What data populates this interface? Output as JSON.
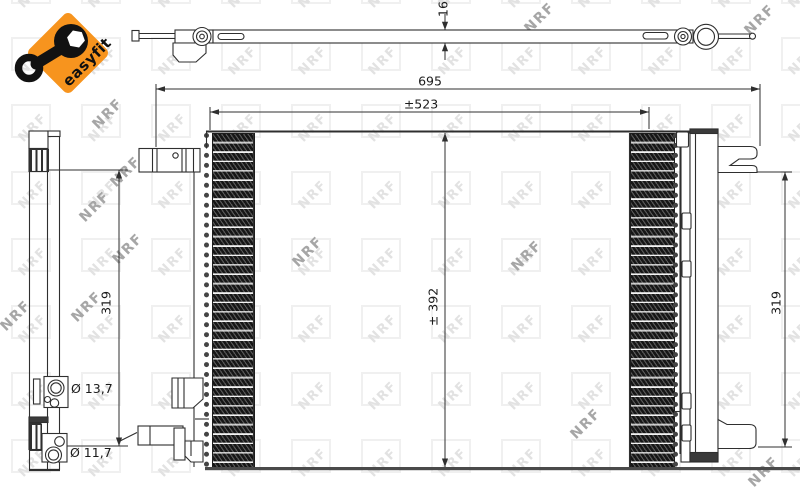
{
  "drawing": {
    "watermark_text": "NRF",
    "easyfit_badge": {
      "label": "easyfit",
      "background": "#F7941E"
    },
    "dimensions": {
      "thickness_top_view": "16",
      "overall_width": "695",
      "tube_width": "±523",
      "core_height": "± 392",
      "left_mount_height": "319",
      "right_mount_height": "319",
      "upper_port_diameter": "Ø 13,7",
      "lower_port_diameter": "Ø 11,7"
    }
  }
}
